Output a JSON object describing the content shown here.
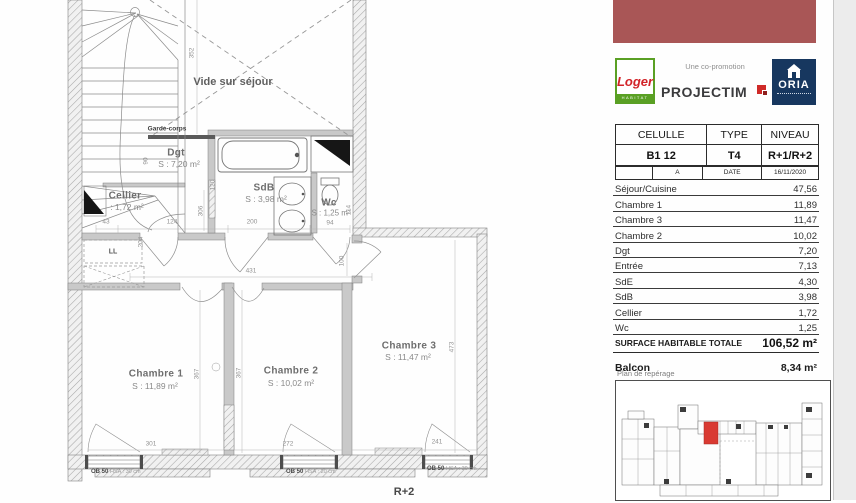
{
  "colors": {
    "header_block": "#a95656",
    "loger_green": "#5aa024",
    "loger_red": "#d22328",
    "projectim_dark": "#3b3b3d",
    "projectim_red": "#cf2a28",
    "oria_navy": "#17375f",
    "keyplan_highlight": "#d93a32"
  },
  "sidebar": {
    "logos": {
      "loger_name": "Loger",
      "loger_sub": "HABITAT",
      "co_promotion": "Une co-promotion",
      "projectim": "PROJECTIM",
      "oria": "ORIA"
    },
    "info_table": {
      "headers": [
        "CELULLE",
        "TYPE",
        "NIVEAU"
      ],
      "values": [
        "B1 12",
        "T4",
        "R+1/R+2"
      ]
    },
    "revision": {
      "index": "A",
      "date_label": "DATE",
      "date_value": "16/11/2020"
    },
    "rooms": [
      {
        "name": "Séjour/Cuisine",
        "area": "47,56"
      },
      {
        "name": "Chambre 1",
        "area": "11,89"
      },
      {
        "name": "Chambre 3",
        "area": "11,47"
      },
      {
        "name": "Chambre 2",
        "area": "10,02"
      },
      {
        "name": "Dgt",
        "area": "7,20"
      },
      {
        "name": "Entrée",
        "area": "7,13"
      },
      {
        "name": "SdE",
        "area": "4,30"
      },
      {
        "name": "SdB",
        "area": "3,98"
      },
      {
        "name": "Cellier",
        "area": "1,72"
      },
      {
        "name": "Wc",
        "area": "1,25"
      }
    ],
    "total": {
      "label": "SURFACE HABITABLE TOTALE",
      "value": "106,52 m²"
    },
    "balcon": {
      "label": "Balcon",
      "value": "8,34 m²"
    },
    "keyplan_label": "Plan de repérage"
  },
  "plan": {
    "level_label": "R+2",
    "labels": {
      "vide": "Vide sur séjour",
      "garde_corps": "Garde-corps",
      "ll": "LL",
      "dgt_name": "Dgt",
      "dgt_area": "S : 7,20 m²",
      "cellier_name": "Cellier",
      "cellier_area": ": 1,72 m²",
      "sdb_name": "SdB",
      "sdb_area": "S : 3,98 m²",
      "wc_name": "Wc",
      "wc_area": "S : 1,25 m²",
      "ch1_name": "Chambre 1",
      "ch1_area": "S : 11,89 m²",
      "ch2_name": "Chambre 2",
      "ch2_area": "S : 10,02 m²",
      "ch3_name": "Chambre 3",
      "ch3_area": "S : 11,47 m²"
    },
    "dims": {
      "d352": "352",
      "d90": "90",
      "d120": "120",
      "d306": "306",
      "d204": "204",
      "d43": "43",
      "d124": "124",
      "d200": "200",
      "d94": "94",
      "d114": "114",
      "d431": "431",
      "d100": "100",
      "d367a": "367",
      "d367b": "367",
      "d473": "473",
      "d301": "301",
      "d272": "272",
      "d241": "241"
    },
    "windows": [
      {
        "code": "OB 50",
        "note": "HSA : 30 cm"
      },
      {
        "code": "OB 50",
        "note": "HSA : 20 cm"
      },
      {
        "code": "OB 50",
        "note": "HSA : 30 cm"
      }
    ]
  }
}
